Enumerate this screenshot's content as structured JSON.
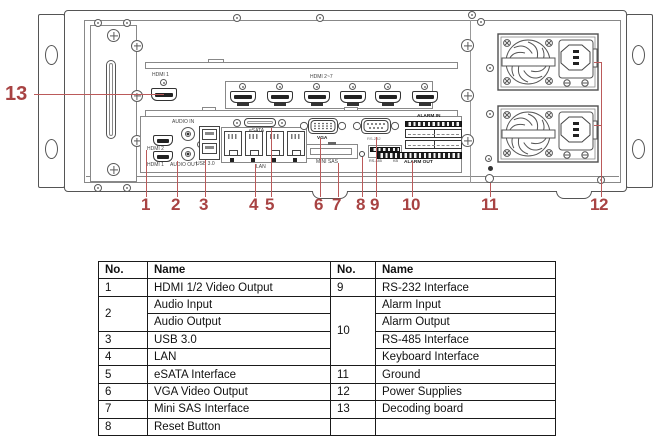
{
  "device": {
    "accent_color": "#a84343",
    "callouts": {
      "c1": "1",
      "c2": "2",
      "c3": "3",
      "c4": "4",
      "c5": "5",
      "c6": "6",
      "c7": "7",
      "c8": "8",
      "c9": "9",
      "c10": "10",
      "c11": "11",
      "c12": "12",
      "c13": "13"
    },
    "labels": {
      "hdmi_single": "HDMI 1",
      "hdmi_group": "HDMI 2~7",
      "hdmi2": "HDMI 2",
      "hdmi1": "HDMI 1",
      "audio_in": "AUDIO IN",
      "audio_out": "AUDIO OUT",
      "usb": "USB 3.0",
      "lan": "LAN",
      "esata": "eSATA",
      "vga": "VGA",
      "mini_sas": "MINI SAS",
      "rs232": "RS-232",
      "rs485": "RS-485",
      "kb": "KB",
      "alarm_in": "ALARM IN",
      "alarm_out": "ALARM OUT"
    }
  },
  "table": {
    "headers": [
      "No.",
      "Name",
      "No.",
      "Name"
    ],
    "rows": [
      {
        "no_left": "1",
        "name_left": "HDMI 1/2 Video Output",
        "no_right": "9",
        "name_right": "RS-232 Interface"
      },
      {
        "no_left": "2",
        "name_left": "Audio Input",
        "no_right": "10",
        "name_right": "Alarm Input"
      },
      {
        "name_left": "Audio Output",
        "name_right": "Alarm Output"
      },
      {
        "no_left": "3",
        "name_left": "USB 3.0",
        "name_right": "RS-485 Interface"
      },
      {
        "no_left": "4",
        "name_left": "LAN",
        "name_right": "Keyboard Interface"
      },
      {
        "no_left": "5",
        "name_left": "eSATA Interface",
        "no_right": "11",
        "name_right": "Ground"
      },
      {
        "no_left": "6",
        "name_left": "VGA Video Output",
        "no_right": "12",
        "name_right": "Power Supplies"
      },
      {
        "no_left": "7",
        "name_left": "Mini SAS Interface",
        "no_right": "13",
        "name_right": "Decoding board"
      },
      {
        "no_left": "8",
        "name_left": "Reset Button",
        "no_right": "",
        "name_right": ""
      }
    ]
  }
}
